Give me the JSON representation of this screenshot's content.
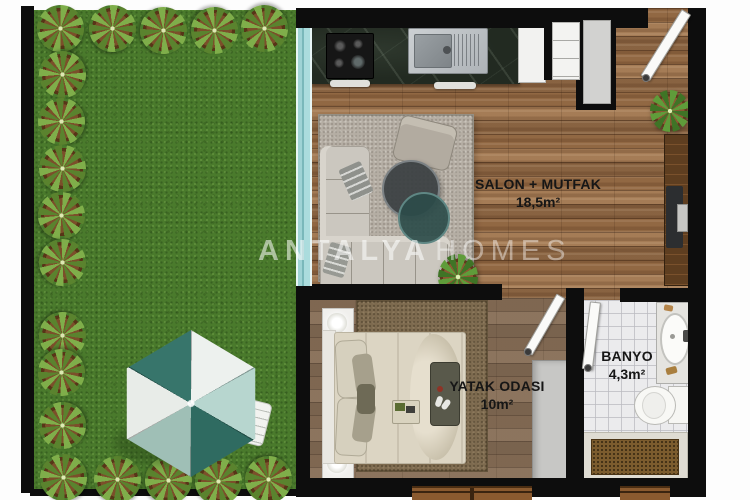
{
  "plan": {
    "watermark": {
      "first": "ANTALYA",
      "second": "HOMES"
    },
    "rooms": [
      {
        "name": "SALON + MUTFAK",
        "area": "18,5m²"
      },
      {
        "name": "YATAK ODASI",
        "area": "10m²"
      },
      {
        "name": "BANYO",
        "area": "4,3m²"
      }
    ],
    "colors": {
      "wall": "#0d0d0d",
      "grass": "#4a7a2c",
      "wood_living": "#9c744f",
      "wood_bedroom": "#8a6e55",
      "tile_bathroom": "#ebebed",
      "counter_marble": "#222a21",
      "sliding_door_glass": "#a5d8da",
      "umbrella_teal": "#37756b",
      "label_text": "#161616",
      "watermark_white": "#ffffff"
    }
  }
}
